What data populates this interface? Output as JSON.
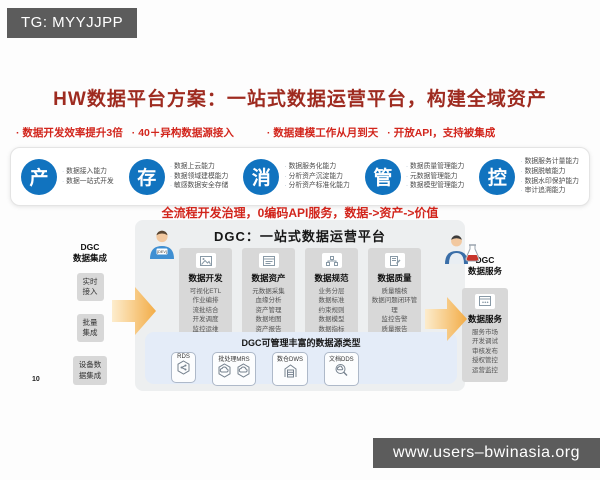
{
  "colors": {
    "accent_blue": "#1173bf",
    "highlight_red": "#d2251c",
    "title_maroon": "#9e2b20",
    "arrow_orange": "#f3a93e",
    "badge_gray": "#5c5c5c",
    "panel_gray": "#edeff0",
    "column_gray": "#d8d8d8",
    "datasource_blue": "#e4ecf8"
  },
  "top_badge": {
    "text": "TG: MYYJJPP"
  },
  "site_badge": {
    "text": "www.users–bwinasia.org"
  },
  "title": "HW数据平台方案：一站式数据运营平台，构建全域资产",
  "highlights": [
    "数据开发效率提升3倍",
    "40＋异构数据源接入",
    "数据建模工作从月到天",
    "开放API，支持被集成"
  ],
  "capabilities": [
    {
      "key": "产",
      "items": [
        "数据接入能力",
        "数据一站式开发"
      ]
    },
    {
      "key": "存",
      "items": [
        "数据上云能力",
        "数据领域建模能力",
        "敏感数据安全存储"
      ]
    },
    {
      "key": "消",
      "items": [
        "数据服务化能力",
        "分析资产沉淀能力",
        "分析资产标准化能力"
      ]
    },
    {
      "key": "管",
      "items": [
        "数据质量管理能力",
        "元数据管理能力",
        "数据模型管理能力"
      ]
    },
    {
      "key": "控",
      "items": [
        "数据服务计量能力",
        "数据脱敏能力",
        "数据水印保护能力",
        "审计追溯能力"
      ]
    }
  ],
  "slogan": "全流程开发治理，0编码API服务，数据->资产->价值",
  "diagram": {
    "personas": {
      "dev_badge": "{DEV}"
    },
    "left": {
      "title": "DGC\n数据集成",
      "boxes": [
        "实时\n接入",
        "批量\n集成",
        "设备数\n据集成"
      ]
    },
    "platform": {
      "title": "DGC：一站式数据运营平台",
      "columns": [
        {
          "label": "数据开发",
          "icon": "image-icon",
          "items": [
            "可视化ETL",
            "作业编排",
            "流批结合",
            "开发调度",
            "监控运维"
          ]
        },
        {
          "label": "数据资产",
          "icon": "document-icon",
          "items": [
            "元数据采集",
            "血缘分析",
            "资产管理",
            "数据地图",
            "资产报告"
          ]
        },
        {
          "label": "数据规范",
          "icon": "flow-icon",
          "items": [
            "业务分层",
            "数据标准",
            "约束规则",
            "数据模型",
            "数据指标"
          ]
        },
        {
          "label": "数据质量",
          "icon": "file-check-icon",
          "items": [
            "质量稽核",
            "数据问题闭环管理",
            "监控告警",
            "质量报告"
          ]
        }
      ],
      "datasources": {
        "title": "DGC可管理丰富的数据源类型",
        "groups": [
          {
            "label": "RDS",
            "icons": [
              "hexagon-db-icon"
            ]
          },
          {
            "label": "批处理MRS",
            "icons": [
              "hexagon-cloud-icon",
              "hexagon-cloud-icon"
            ]
          },
          {
            "label": "数仓DWS",
            "icons": [
              "warehouse-icon"
            ]
          },
          {
            "label": "文档DDS",
            "icons": [
              "magnifier-db-icon"
            ]
          }
        ]
      }
    },
    "right": {
      "title": "DGC\n数据服务",
      "column": {
        "label": "数据服务",
        "icon": "api-icon",
        "items": [
          "服务市场",
          "开发调试",
          "审核发布",
          "授权管控",
          "运营监控"
        ]
      }
    }
  },
  "page_number": "10"
}
